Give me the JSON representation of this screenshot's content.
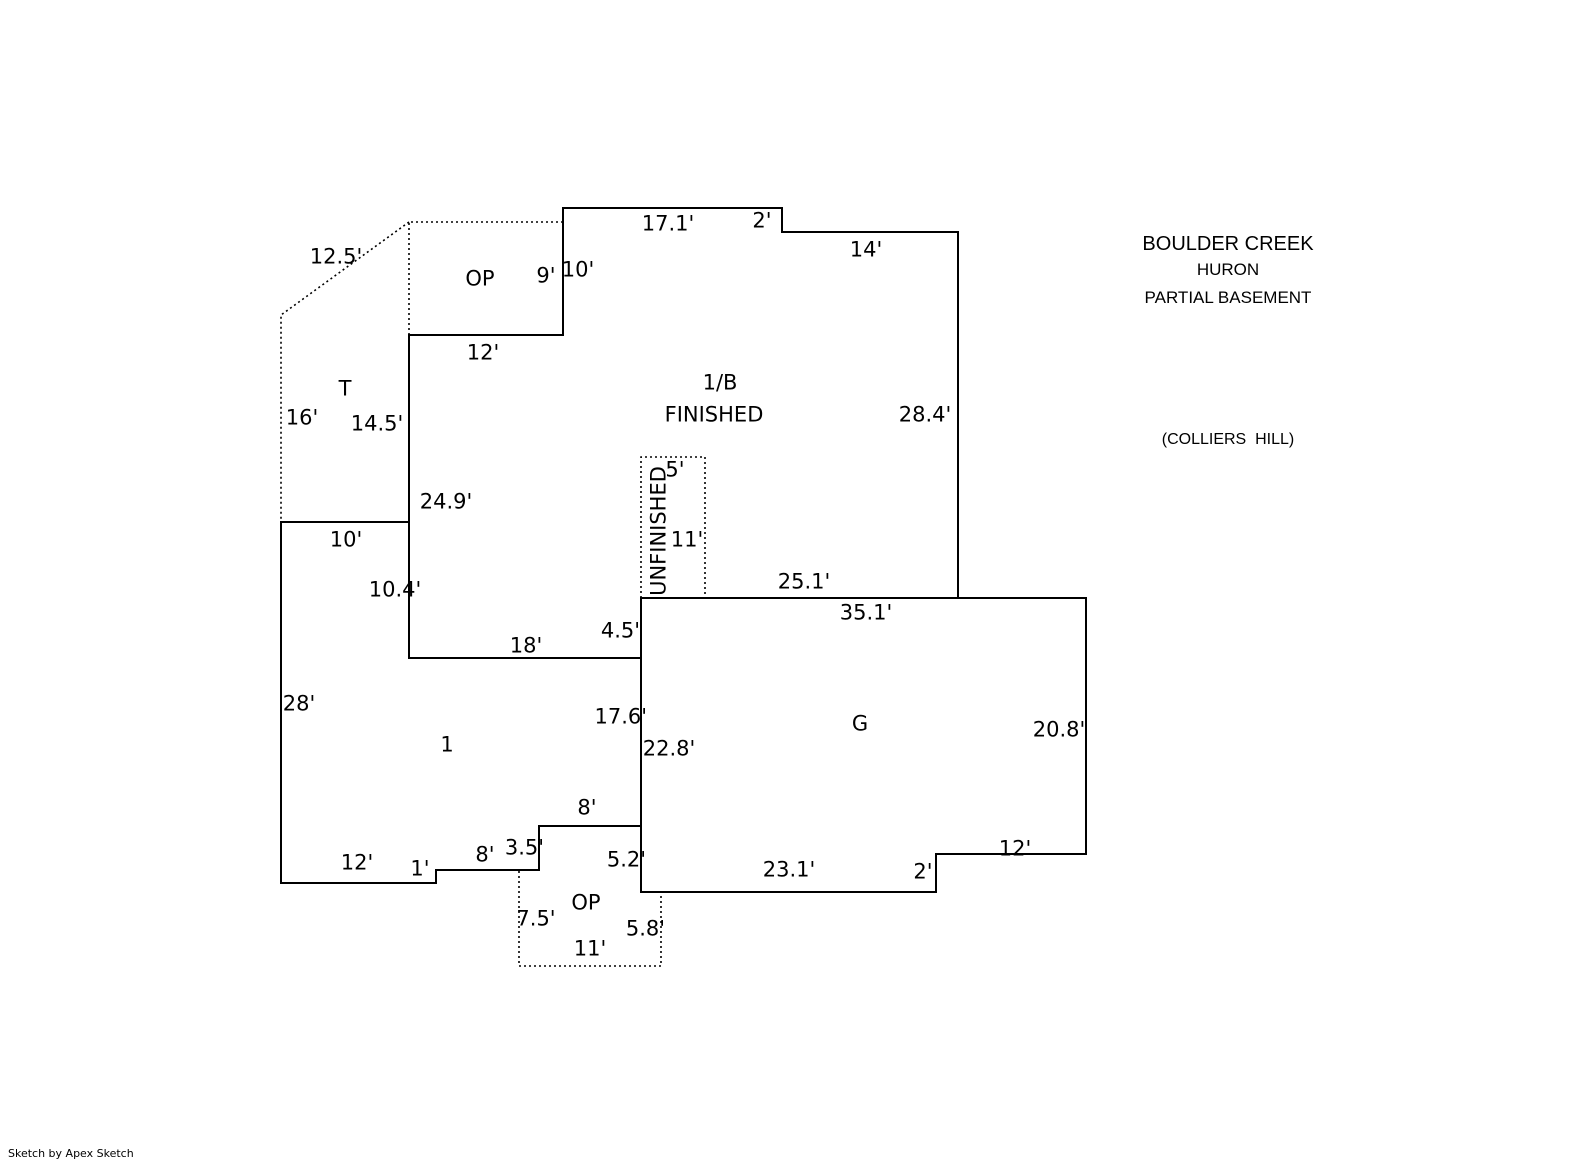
{
  "title_block": {
    "model": "BOULDER CREEK",
    "elevation": "HURON",
    "basement": "PARTIAL BASEMENT",
    "community": "(COLLIERS  HILL)"
  },
  "watermark": "Sketch by Apex Sketch",
  "colors": {
    "background": "#ffffff",
    "lines": "#000000",
    "text": "#000000"
  },
  "floorplan": {
    "shapes": [
      {
        "name": "basement-finished-outline",
        "closed": true,
        "style": "solid",
        "points": [
          [
            563,
            208
          ],
          [
            782,
            208
          ],
          [
            782,
            232
          ],
          [
            958,
            232
          ],
          [
            958,
            598
          ],
          [
            641,
            598
          ],
          [
            641,
            658
          ],
          [
            409,
            658
          ],
          [
            409,
            335
          ],
          [
            563,
            335
          ]
        ]
      },
      {
        "name": "garage-outline",
        "closed": true,
        "style": "solid",
        "points": [
          [
            641,
            598
          ],
          [
            1086,
            598
          ],
          [
            1086,
            854
          ],
          [
            936,
            854
          ],
          [
            936,
            892
          ],
          [
            641,
            892
          ]
        ]
      },
      {
        "name": "first-floor-outline",
        "closed": true,
        "style": "solid",
        "points": [
          [
            281,
            522
          ],
          [
            409,
            522
          ],
          [
            409,
            658
          ],
          [
            641,
            658
          ],
          [
            641,
            826
          ],
          [
            539,
            826
          ],
          [
            539,
            870
          ],
          [
            436,
            870
          ],
          [
            436,
            883
          ],
          [
            281,
            883
          ]
        ]
      },
      {
        "name": "open-porch-top-outline",
        "closed": false,
        "style": "dotted",
        "points": [
          [
            563,
            222
          ],
          [
            409,
            222
          ],
          [
            409,
            335
          ]
        ]
      },
      {
        "name": "patio-outline",
        "closed": false,
        "style": "dotted",
        "points": [
          [
            409,
            222
          ],
          [
            281,
            315
          ],
          [
            281,
            522
          ]
        ]
      },
      {
        "name": "unfinished-basement-outline",
        "closed": false,
        "style": "dotted",
        "points": [
          [
            641,
            598
          ],
          [
            641,
            457
          ],
          [
            705,
            457
          ],
          [
            705,
            598
          ]
        ]
      },
      {
        "name": "open-porch-bottom-outline",
        "closed": false,
        "style": "dotted",
        "points": [
          [
            519,
            871
          ],
          [
            519,
            966
          ],
          [
            661,
            966
          ],
          [
            661,
            892
          ]
        ]
      }
    ],
    "dimension_labels": [
      {
        "text": "12.5'",
        "x": 336,
        "y": 257
      },
      {
        "text": "9'",
        "x": 546,
        "y": 276
      },
      {
        "text": "10'",
        "x": 578,
        "y": 270
      },
      {
        "text": "17.1'",
        "x": 668,
        "y": 224
      },
      {
        "text": "2'",
        "x": 762,
        "y": 221
      },
      {
        "text": "14'",
        "x": 866,
        "y": 250
      },
      {
        "text": "12'",
        "x": 483,
        "y": 353
      },
      {
        "text": "16'",
        "x": 302,
        "y": 418
      },
      {
        "text": "14.5'",
        "x": 377,
        "y": 424
      },
      {
        "text": "28.4'",
        "x": 925,
        "y": 415
      },
      {
        "text": "24.9'",
        "x": 446,
        "y": 502
      },
      {
        "text": "5'",
        "x": 675,
        "y": 470
      },
      {
        "text": "11'",
        "x": 687,
        "y": 540
      },
      {
        "text": "25.1'",
        "x": 804,
        "y": 582
      },
      {
        "text": "35.1'",
        "x": 866,
        "y": 613
      },
      {
        "text": "10'",
        "x": 346,
        "y": 540
      },
      {
        "text": "10.4'",
        "x": 395,
        "y": 590
      },
      {
        "text": "4.5'",
        "x": 640,
        "y": 631,
        "align": "right"
      },
      {
        "text": "18'",
        "x": 526,
        "y": 646
      },
      {
        "text": "28'",
        "x": 299,
        "y": 704
      },
      {
        "text": "17.6'",
        "x": 647,
        "y": 717,
        "align": "right"
      },
      {
        "text": "22.8'",
        "x": 669,
        "y": 749
      },
      {
        "text": "20.8'",
        "x": 1059,
        "y": 730
      },
      {
        "text": "8'",
        "x": 587,
        "y": 808
      },
      {
        "text": "3.5'",
        "x": 544,
        "y": 848,
        "align": "right"
      },
      {
        "text": "8'",
        "x": 485,
        "y": 855
      },
      {
        "text": "1'",
        "x": 420,
        "y": 869
      },
      {
        "text": "12'",
        "x": 357,
        "y": 863
      },
      {
        "text": "5.2'",
        "x": 646,
        "y": 860,
        "align": "right"
      },
      {
        "text": "23.1'",
        "x": 789,
        "y": 870
      },
      {
        "text": "2'",
        "x": 923,
        "y": 872
      },
      {
        "text": "12'",
        "x": 1015,
        "y": 849
      },
      {
        "text": "7.5'",
        "x": 536,
        "y": 919
      },
      {
        "text": "5.8'",
        "x": 665,
        "y": 929,
        "align": "right"
      },
      {
        "text": "11'",
        "x": 590,
        "y": 949
      }
    ],
    "area_labels": [
      {
        "text": "OP",
        "x": 480,
        "y": 279
      },
      {
        "text": "T",
        "x": 345,
        "y": 389
      },
      {
        "text": "1/B",
        "x": 720,
        "y": 383
      },
      {
        "text": "FINISHED",
        "x": 714,
        "y": 415
      },
      {
        "text": "UNFINISHED",
        "x": 659,
        "y": 531,
        "rotate": -90
      },
      {
        "text": "1",
        "x": 447,
        "y": 745
      },
      {
        "text": "G",
        "x": 860,
        "y": 724
      },
      {
        "text": "OP",
        "x": 586,
        "y": 903
      }
    ]
  }
}
